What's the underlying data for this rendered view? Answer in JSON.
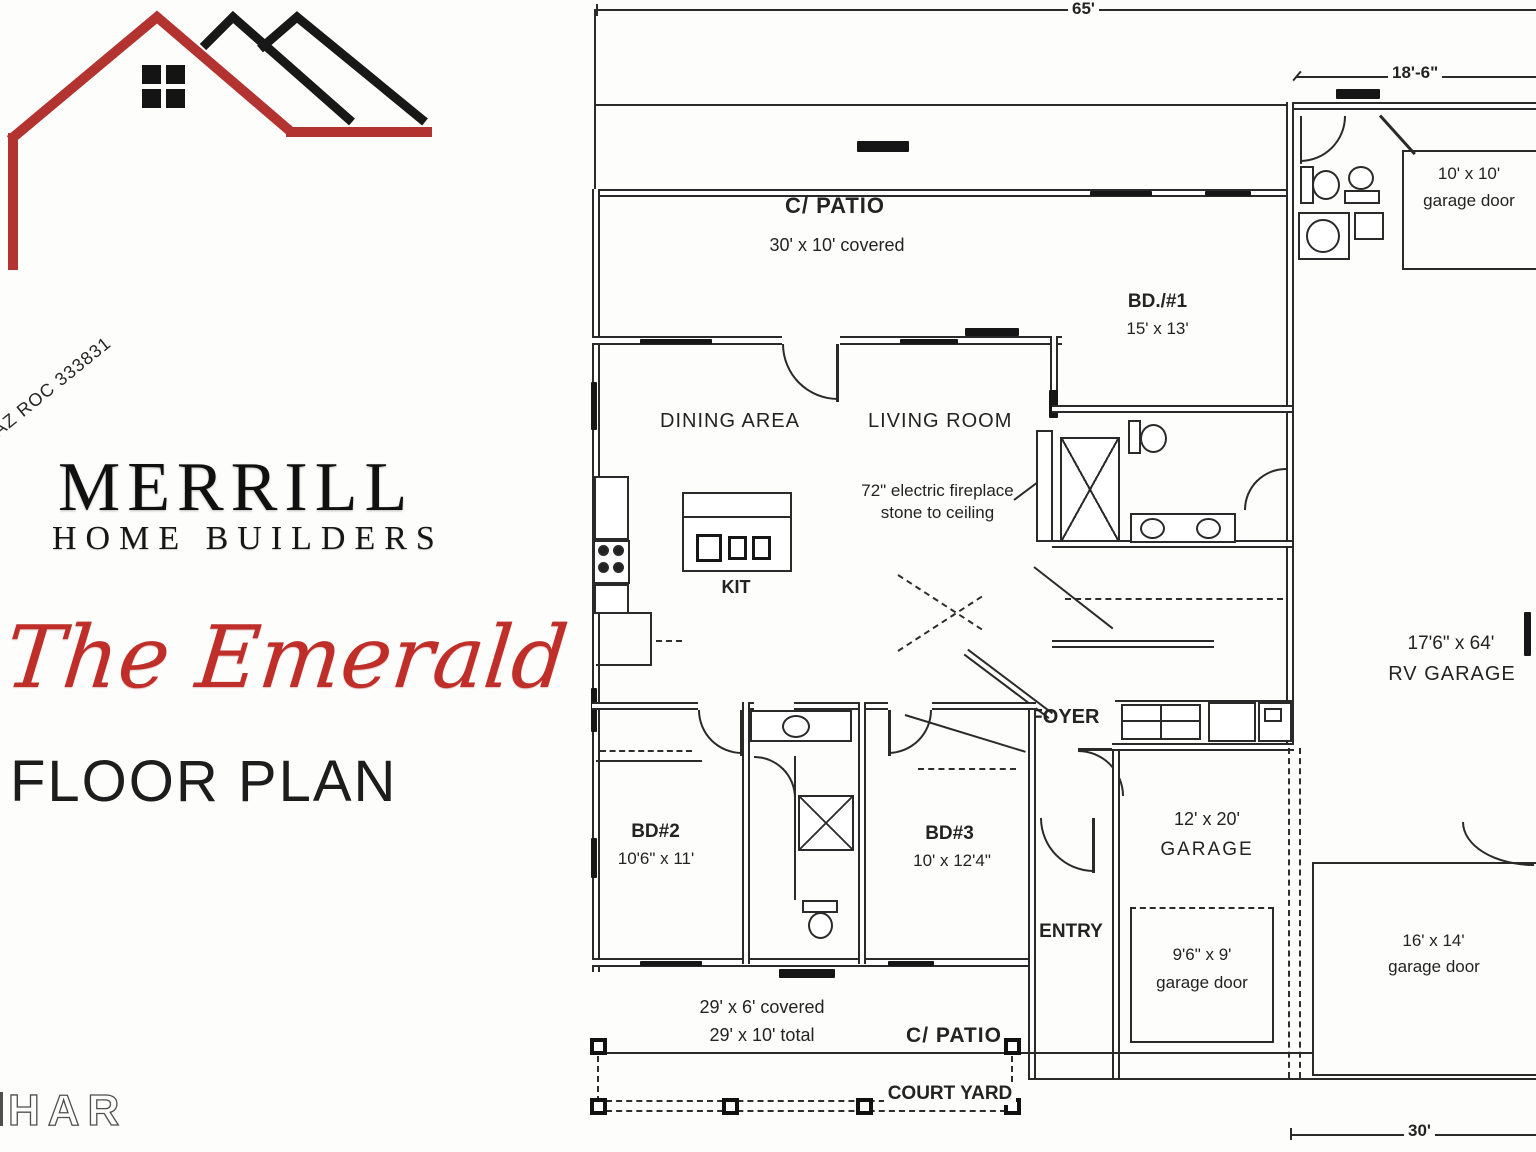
{
  "branding": {
    "license": "AZ ROC 333831",
    "name": "MERRILL",
    "subtitle": "HOME BUILDERS",
    "plan_script": "The Emerald",
    "plan_caption": "FLOOR PLAN",
    "brand_red": "#b23330"
  },
  "watermark": "HAR",
  "dims": {
    "top": "65'",
    "laundry": "18'-6\"",
    "bottom_right": "30'"
  },
  "rooms": {
    "patio_top": {
      "name": "C/ PATIO",
      "size": "30' x 10' covered"
    },
    "dining": {
      "name": "DINING AREA"
    },
    "living": {
      "name": "LIVING ROOM"
    },
    "kitchen": {
      "name": "KIT"
    },
    "bd1": {
      "name": "BD./#1",
      "size": "15' x 13'"
    },
    "foyer": {
      "name": "FOYER"
    },
    "rv_garage": {
      "name": "RV GARAGE",
      "size": "17'6\" x 64'"
    },
    "garage": {
      "name": "GARAGE",
      "size": "12' x 20'"
    },
    "entry": {
      "name": "ENTRY"
    },
    "bd2": {
      "name": "BD#2",
      "size": "10'6\" x 11'"
    },
    "bd3": {
      "name": "BD#3",
      "size": "10' x 12'4\""
    },
    "patio_bottom": {
      "name": "C/ PATIO",
      "size_line1": "29' x 6' covered",
      "size_line2": "29' x 10' total"
    },
    "court_yard": {
      "name": "COURT YARD"
    }
  },
  "notes": {
    "fireplace_line1": "72\" electric fireplace",
    "fireplace_line2": "stone to ceiling"
  },
  "garage_doors": {
    "top_right": {
      "line1": "10' x 10'",
      "line2": "garage door"
    },
    "small": {
      "line1": "9'6\" x 9'",
      "line2": "garage door"
    },
    "large": {
      "line1": "16' x 14'",
      "line2": "garage door"
    }
  }
}
